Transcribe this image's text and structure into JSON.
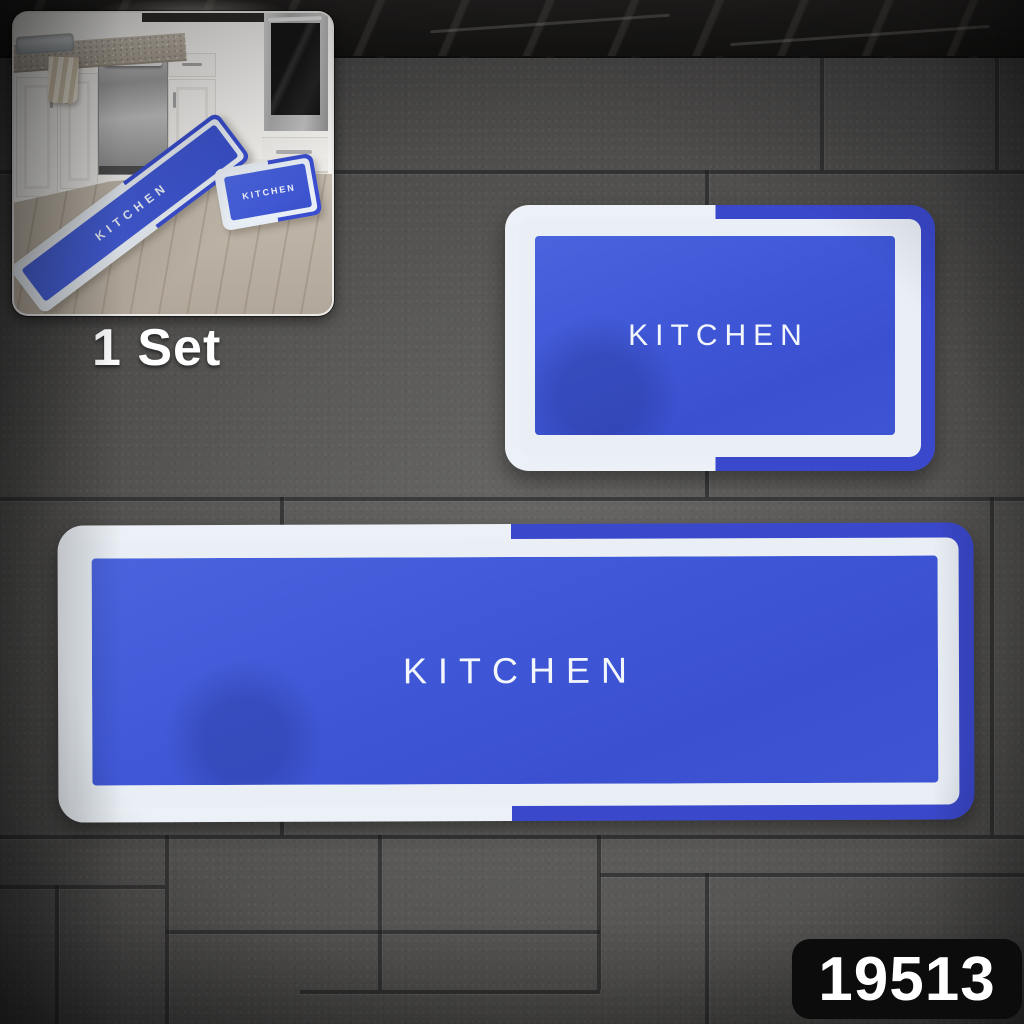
{
  "scene": {
    "set_label": "1 Set",
    "product_code": "19513"
  },
  "mats": {
    "runner_label": "KITCHEN",
    "small_label": "KITCHEN"
  },
  "inset": {
    "runner_label": "KITCHEN",
    "small_label": "KITCHEN"
  },
  "colors": {
    "mat_field_blue": "#4059d8",
    "mat_band_blue": "#3a48cc",
    "mat_white": "#e9eff5",
    "badge_bg": "#0c0c0c",
    "badge_text": "#ffffff",
    "set_label_text": "#ffffff",
    "tile_gray": "#5a5957",
    "grout_gray": "#2e2d30",
    "marble_black": "#171615",
    "inset_floor_wood": "#c7beb2"
  }
}
